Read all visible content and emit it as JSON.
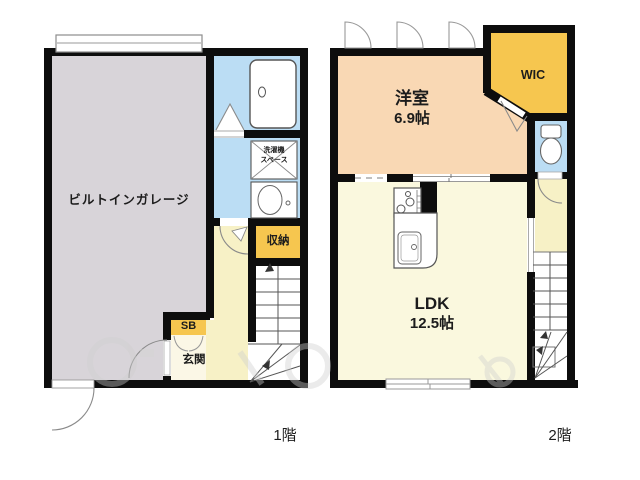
{
  "floor1": {
    "floor_label": "1階",
    "garage_label": "ビルトインガレージ",
    "laundry_label_line1": "洗濯機",
    "laundry_label_line2": "スペース",
    "storage_label": "収納",
    "shoebox_label": "SB",
    "entrance_label": "玄関"
  },
  "floor2": {
    "floor_label": "2階",
    "bedroom_name": "洋室",
    "bedroom_size": "6.9帖",
    "wic_label": "WIC",
    "ldk_name": "LDK",
    "ldk_size": "12.5帖"
  },
  "colors": {
    "wall": "#0d0d0d",
    "garage": "#d8d4d9",
    "wet_area_blue": "#bbddf4",
    "bedroom_peach": "#f9d8b4",
    "closet_orange": "#f6c64f",
    "hall_yellow": "#f7f1c6",
    "ldk_cream": "#faf8de",
    "entrance_cream": "#fbf7e6"
  }
}
